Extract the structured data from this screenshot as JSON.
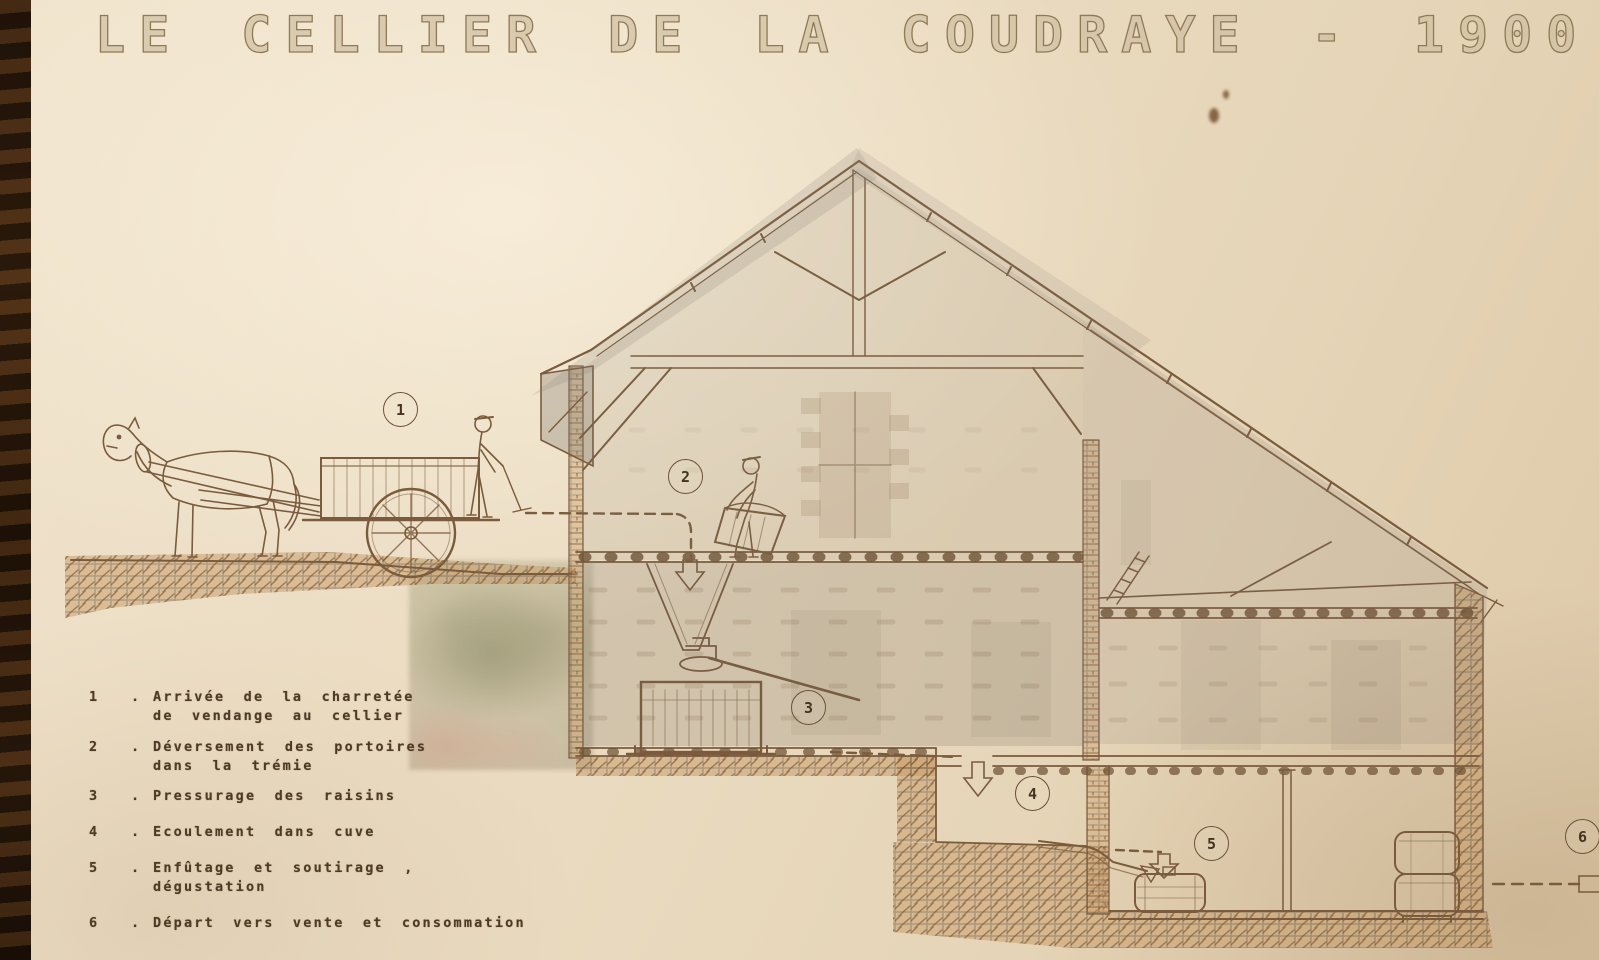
{
  "poster": {
    "title": "LE CELLIER DE LA COUDRAYE - 1900",
    "legend": {
      "sep": ".",
      "items": [
        {
          "num": "1",
          "line1": "Arrivée de la charretée",
          "line2": "de vendange au cellier"
        },
        {
          "num": "2",
          "line1": "Déversement des portoires",
          "line2": "dans la trémie"
        },
        {
          "num": "3",
          "line1": "Pressurage des raisins",
          "line2": ""
        },
        {
          "num": "4",
          "line1": "Ecoulement dans cuve",
          "line2": ""
        },
        {
          "num": "5",
          "line1": "Enfûtage et soutirage , dégustation",
          "line2": ""
        },
        {
          "num": "6",
          "line1": "Départ vers vente et consommation",
          "line2": ""
        }
      ]
    },
    "markers": {
      "m1": "1",
      "m2": "2",
      "m3": "3",
      "m4": "4",
      "m5": "5",
      "m6": "6"
    },
    "colors": {
      "paper": "#e9dac2",
      "ink": "#7a5b3d",
      "legend_ink": "#4e3a25",
      "earth": "#b5854f"
    }
  }
}
